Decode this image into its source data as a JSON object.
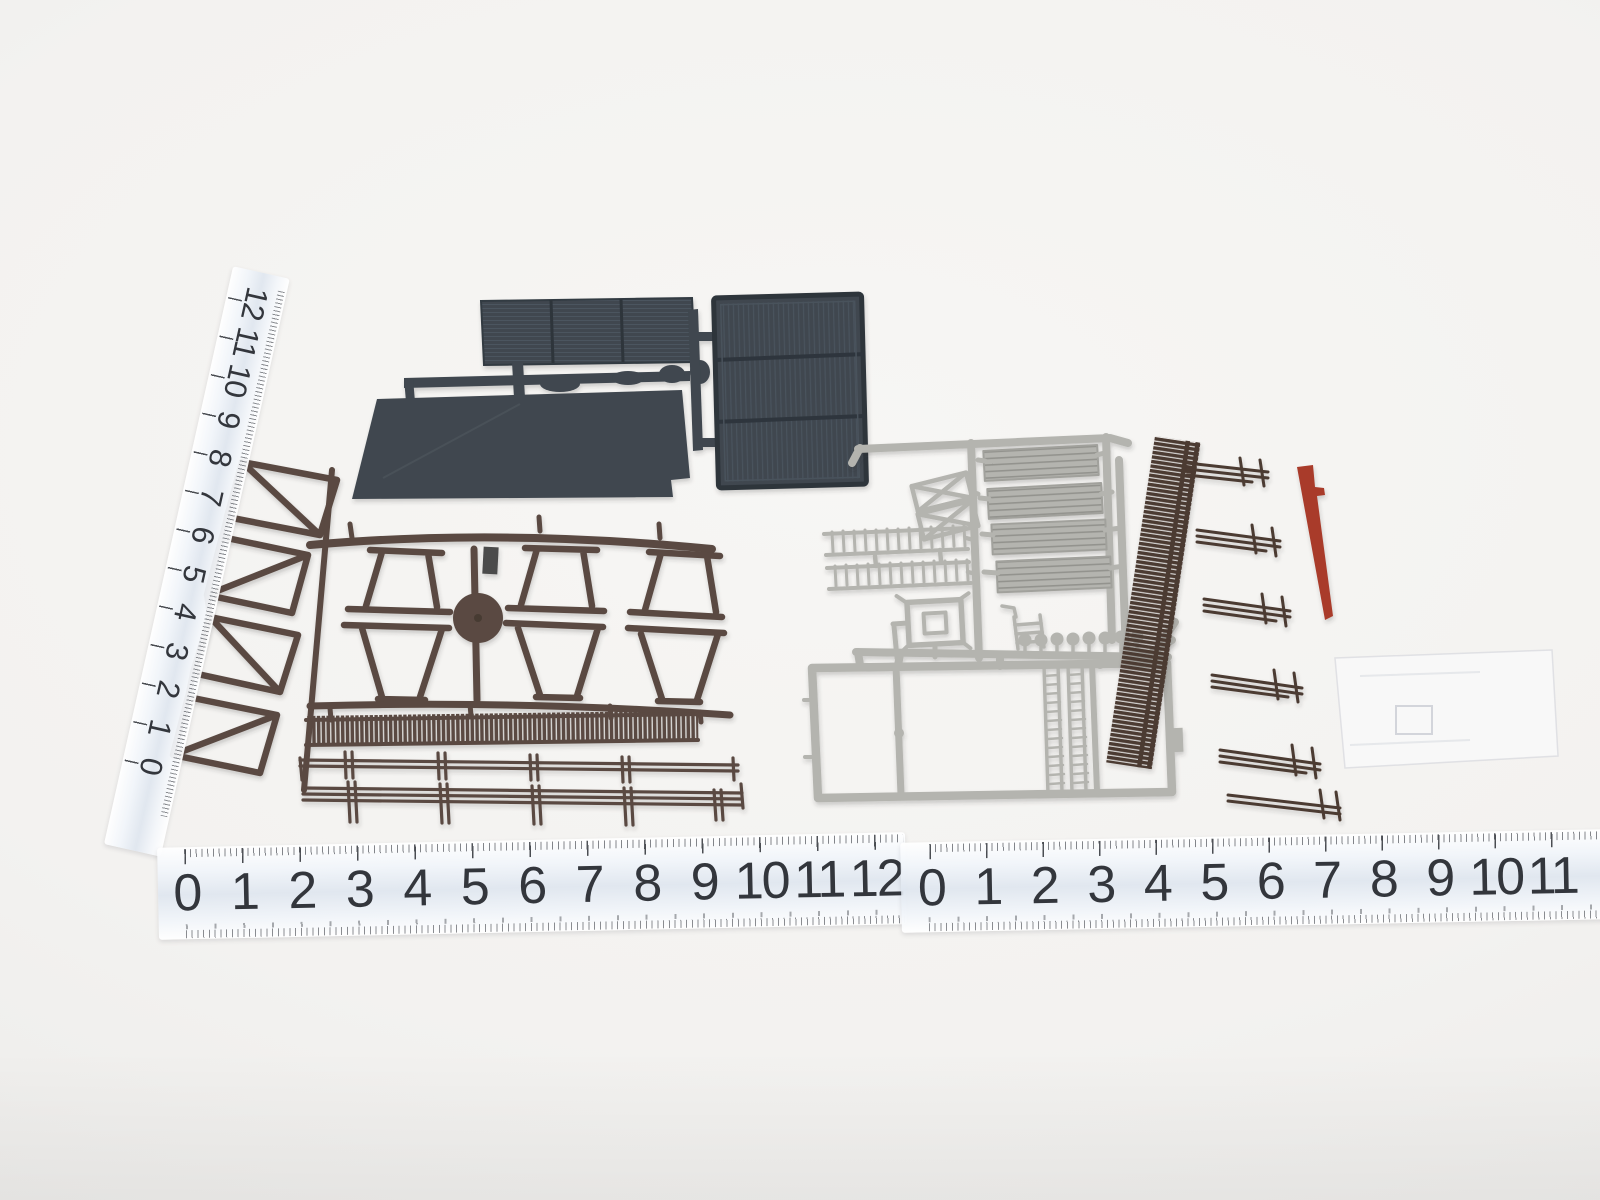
{
  "scene": {
    "description": "Photograph of unassembled model-railway kit sprues - dark gray roof and door panels, brown fence and frame parts, light gray platform, ladder and truss parts, a dark brown trackside fence strip, a red signal arm and a clear glazing part - laid on a white surface with three centimetre rulers",
    "background_color": "#f3f2f0"
  },
  "rulers": {
    "unit": "cm",
    "digit_color": "#33363c",
    "band_color": "#dfe6ef",
    "tick_color": "#4a4d52",
    "vertical_left": {
      "numbers": [
        "12",
        "11",
        "10",
        "9",
        "8",
        "7",
        "6",
        "5",
        "4",
        "3",
        "2",
        "1",
        "0"
      ]
    },
    "bottom_left": {
      "numbers": [
        "0",
        "1",
        "2",
        "3",
        "4",
        "5",
        "6",
        "7",
        "8",
        "9",
        "10",
        "11",
        "12"
      ]
    },
    "bottom_right": {
      "numbers": [
        "0",
        "1",
        "2",
        "3",
        "4",
        "5",
        "6",
        "7",
        "8",
        "9",
        "10",
        "11"
      ]
    }
  },
  "parts": {
    "dark_gray": {
      "label": "dark gray roof and door panels sprue",
      "color": "#3f474f",
      "edge": "#2e343b",
      "rib": "#4b545e"
    },
    "brown": {
      "label": "brown fence and frame sprue",
      "color": "#5a4a42"
    },
    "light_gray": {
      "label": "light gray platform, ladder and truss sprue",
      "color": "#b4b4af",
      "shade": "#93938e"
    },
    "dark_brown": {
      "label": "dark brown trackside fence sprue",
      "color": "#4c3a31"
    },
    "red": {
      "label": "red signal arm",
      "color": "#a93b2b"
    },
    "clear": {
      "label": "clear glazing part",
      "color": "#f6f7f9",
      "edge": "#ccd0d7"
    }
  }
}
